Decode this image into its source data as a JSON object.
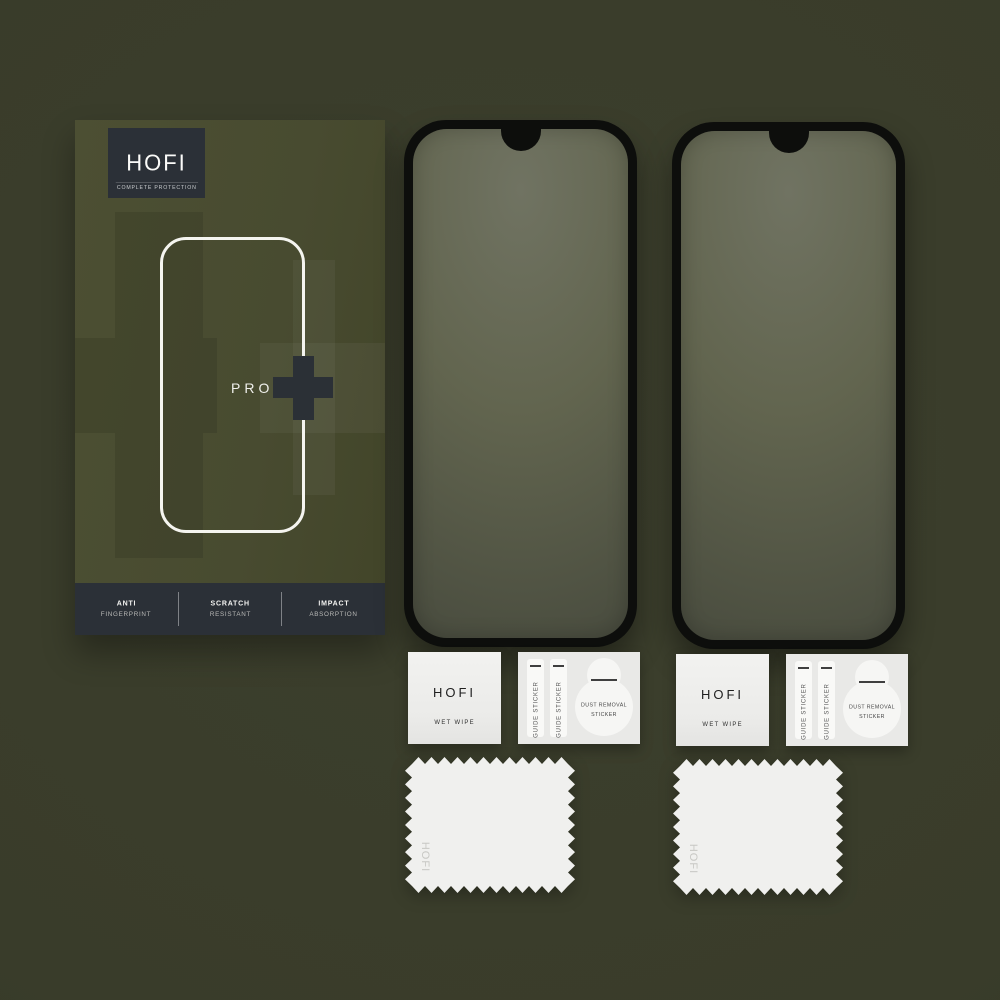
{
  "scene": {
    "background_color": "#393c2a",
    "description_colors": {
      "box_face": "#484b30",
      "dark_panel": "#2b3037",
      "protector_frame": "#0d0e0c",
      "glass_top": "#6f7261",
      "glass_bottom": "#4b4e40",
      "paper_white": "#efefed"
    }
  },
  "box": {
    "brand": "HOFI",
    "tagline": "COMPLETE PROTECTION",
    "model": "PRO",
    "plus_icon": "+",
    "features": [
      {
        "line1": "ANTI",
        "line2": "FINGERPRINT"
      },
      {
        "line1": "SCRATCH",
        "line2": "RESISTANT"
      },
      {
        "line1": "IMPACT",
        "line2": "ABSORPTION"
      }
    ]
  },
  "protector_count": 2,
  "kits": [
    {
      "wet_wipe_brand": "HOFI",
      "wet_wipe_label": "WET WIPE",
      "guide_sticker_label_1": "GUIDE STICKER",
      "guide_sticker_label_2": "GUIDE STICKER",
      "dust_removal_label": "DUST REMOVAL STICKER",
      "cloth_brand": "HOFI"
    },
    {
      "wet_wipe_brand": "HOFI",
      "wet_wipe_label": "WET WIPE",
      "guide_sticker_label_1": "GUIDE STICKER",
      "guide_sticker_label_2": "GUIDE STICKER",
      "dust_removal_label": "DUST REMOVAL STICKER",
      "cloth_brand": "HOFI"
    }
  ]
}
